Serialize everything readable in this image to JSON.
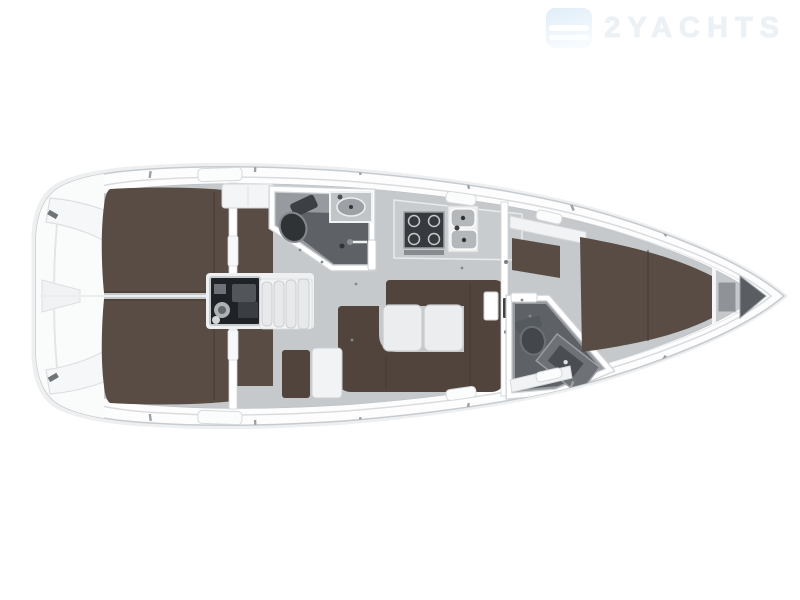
{
  "watermark": {
    "text": "2YACHTS",
    "logo": "waves-logo-icon"
  },
  "colors": {
    "background": "#ffffff",
    "hull_shadow": "#edeff1",
    "hull_fill": "#fdfdfe",
    "hull_stroke": "#c7cbce",
    "deck_line": "#d9dcdf",
    "deck_line_light": "#e7e9eb",
    "interior_floor": "#c6c9cc",
    "berth_brown": "#594c44",
    "sofa_brown": "#50443c",
    "seam_brown": "#463a32",
    "wall_white": "#ffffff",
    "wall_stroke": "#cfd3d6",
    "furniture_white": "#f2f3f4",
    "table_white": "#ebedee",
    "counter_gray": "#c9ccce",
    "head_floor": "#979b9f",
    "shower_floor": "#5e6266",
    "dark_fixture": "#2f3336",
    "engine_dark": "#1f2226",
    "metal_gray": "#9b9fa3",
    "sink_gray": "#b4b8bb",
    "locker_gray": "#8f9397",
    "anchor_locker": "#5a5e63",
    "watermark_text": "#ecf1f6",
    "watermark_logo": "#dfedf8"
  },
  "floorplan": {
    "type": "sailing-yacht-interior-deck-plan",
    "orientation": "bow-right",
    "regions": [
      {
        "id": "swim-platform",
        "label": "stern swim platform"
      },
      {
        "id": "aft-cabin-port",
        "label": "aft double berth port"
      },
      {
        "id": "aft-cabin-starboard",
        "label": "aft double berth starboard"
      },
      {
        "id": "engine-compartment",
        "label": "engine under companionway"
      },
      {
        "id": "companionway-steps",
        "label": "companionway steps"
      },
      {
        "id": "aft-head",
        "label": "aft head with shower"
      },
      {
        "id": "galley",
        "label": "galley with stove and twin sinks"
      },
      {
        "id": "salon",
        "label": "salon with U-settee and twin tables"
      },
      {
        "id": "chart-table",
        "label": "chart table and seat"
      },
      {
        "id": "forward-head",
        "label": "forward head with vanity"
      },
      {
        "id": "forward-cabin",
        "label": "forward V-berth cabin"
      },
      {
        "id": "anchor-locker",
        "label": "anchor locker at bow"
      }
    ]
  }
}
